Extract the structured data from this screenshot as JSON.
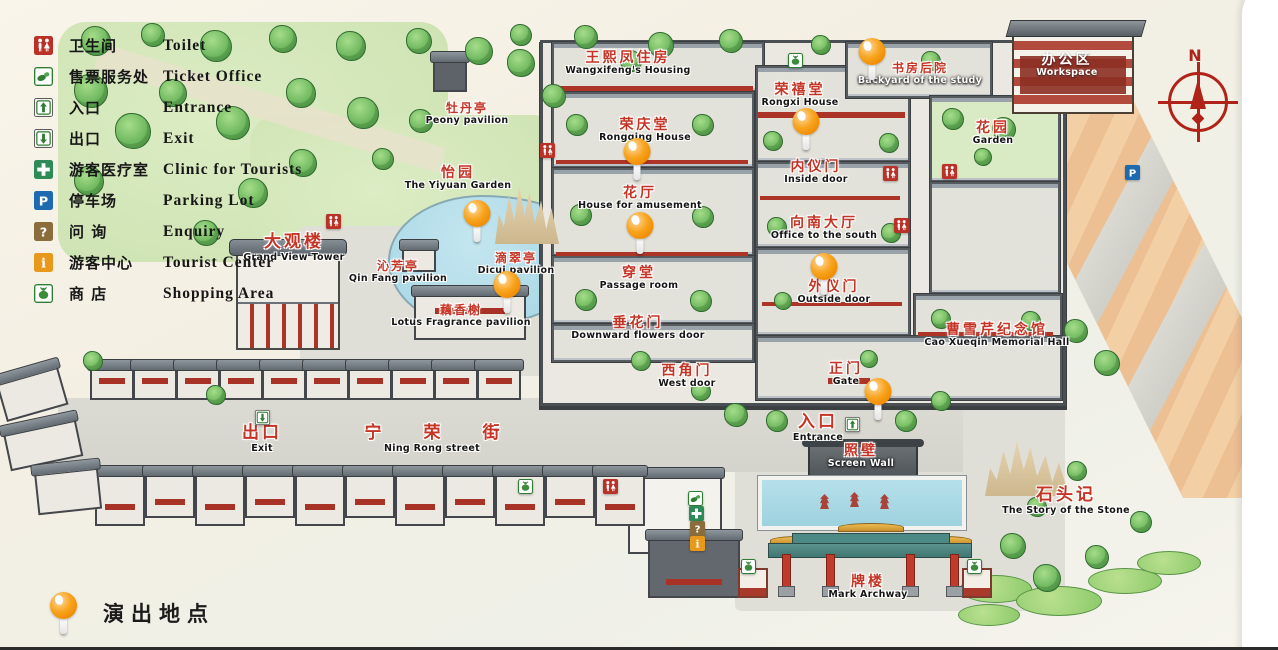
{
  "legend": {
    "items": [
      {
        "zh": "卫生间",
        "en": "Toilet",
        "icon": "toilet"
      },
      {
        "zh": "售票服务处",
        "en": "Ticket Office",
        "icon": "ticket-office"
      },
      {
        "zh": "入口",
        "en": "Entrance",
        "icon": "entrance"
      },
      {
        "zh": "出口",
        "en": "Exit",
        "icon": "exit"
      },
      {
        "zh": "游客医疗室",
        "en": "Clinic for Tourists",
        "icon": "clinic"
      },
      {
        "zh": "停车场",
        "en": "Parking Lot",
        "icon": "parking",
        "glyph": "P"
      },
      {
        "zh": "问 询",
        "en": "Enquiry",
        "icon": "enquiry",
        "glyph": "?"
      },
      {
        "zh": "游客中心",
        "en": "Tourist Center",
        "icon": "tourist-center",
        "glyph": "i"
      },
      {
        "zh": "商 店",
        "en": "Shopping Area",
        "icon": "shopping"
      }
    ],
    "performance": {
      "zh": "演出地点",
      "marker_color": "#ef8a00"
    }
  },
  "compass": {
    "label": "N"
  },
  "colors": {
    "marker_orange": "#ef8a00",
    "label_red": "#c53425"
  },
  "labels": [
    {
      "zh": "王熙凤住房",
      "en": "Wangxifeng's Housing"
    },
    {
      "zh": "书房后院",
      "en": "Backyard of the study"
    },
    {
      "zh": "荣禧堂",
      "en": "Rongxi House"
    },
    {
      "zh": "荣庆堂",
      "en": "Rongqing House"
    },
    {
      "zh": "牡丹亭",
      "en": "Peony pavilion"
    },
    {
      "zh": "花园",
      "en": "Garden"
    },
    {
      "zh": "怡园",
      "en": "The Yiyuan Garden"
    },
    {
      "zh": "内仪门",
      "en": "Inside door"
    },
    {
      "zh": "花厅",
      "en": "House for amusement"
    },
    {
      "zh": "向南大厅",
      "en": "Office to the south"
    },
    {
      "zh": "大观楼",
      "en": "Grand View Tower"
    },
    {
      "zh": "沁芳亭",
      "en": "Qin Fang pavilion"
    },
    {
      "zh": "滴翠亭",
      "en": "Dicui pavilion"
    },
    {
      "zh": "穿堂",
      "en": "Passage room"
    },
    {
      "zh": "外仪门",
      "en": "Outside door"
    },
    {
      "zh": "藕香榭",
      "en": "Lotus Fragrance pavilion"
    },
    {
      "zh": "垂花门",
      "en": "Downward flowers door"
    },
    {
      "zh": "曹雪芹纪念馆",
      "en": "Cao Xueqin Memorial Hall"
    },
    {
      "zh": "西角门",
      "en": "West door"
    },
    {
      "zh": "正门",
      "en": "Gate"
    },
    {
      "zh": "出口",
      "en": "Exit"
    },
    {
      "zh": "宁荣街",
      "en": "Ning Rong street"
    },
    {
      "zh": "入口",
      "en": "Entrance"
    },
    {
      "zh": "照壁",
      "en": "Screen Wall"
    },
    {
      "zh": "石头记",
      "en": "The Story of the Stone"
    },
    {
      "zh": "牌楼",
      "en": "Mark Archway"
    },
    {
      "zh": "办公区",
      "en": "Workspace"
    }
  ]
}
